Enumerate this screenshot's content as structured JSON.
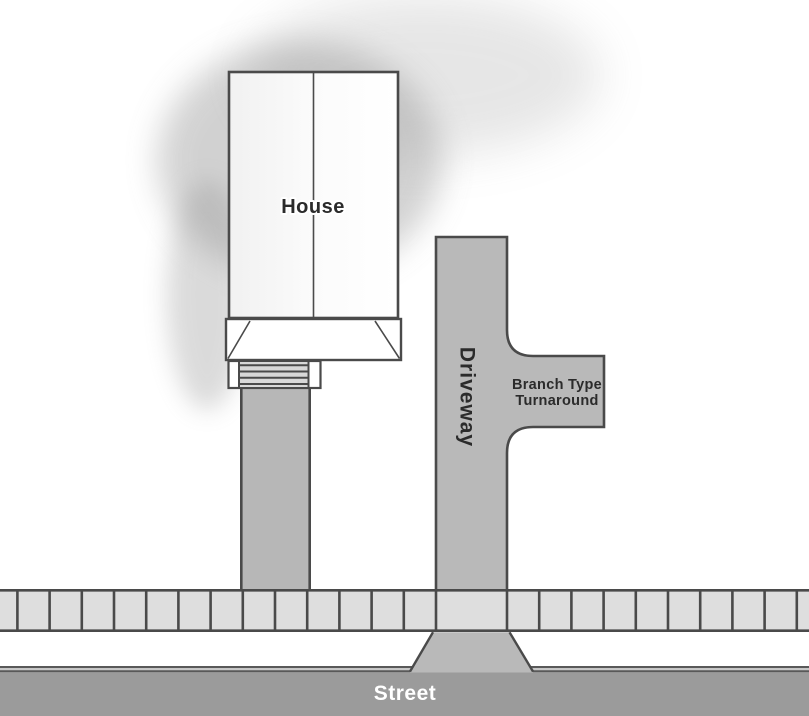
{
  "diagram": {
    "title": "Branch type driveway turnaround site plan",
    "labels": {
      "house": "House",
      "driveway": "Driveway",
      "turnaround_line1": "Branch Type",
      "turnaround_line2": "Turnaround",
      "street": "Street"
    }
  },
  "colors": {
    "outline": "#4a4a4a",
    "pavement": "#b9b9b9",
    "walkway": "#b7b7b7",
    "sidewalk": "#dedede",
    "street": "#9b9b9b",
    "steps": "#d8d8d8",
    "curb_dark": "#595959",
    "curb_light": "#c9c9c9",
    "label_dark": "#2b2b2b",
    "label_light": "#ffffff",
    "shadow": "#8f8f8f"
  }
}
